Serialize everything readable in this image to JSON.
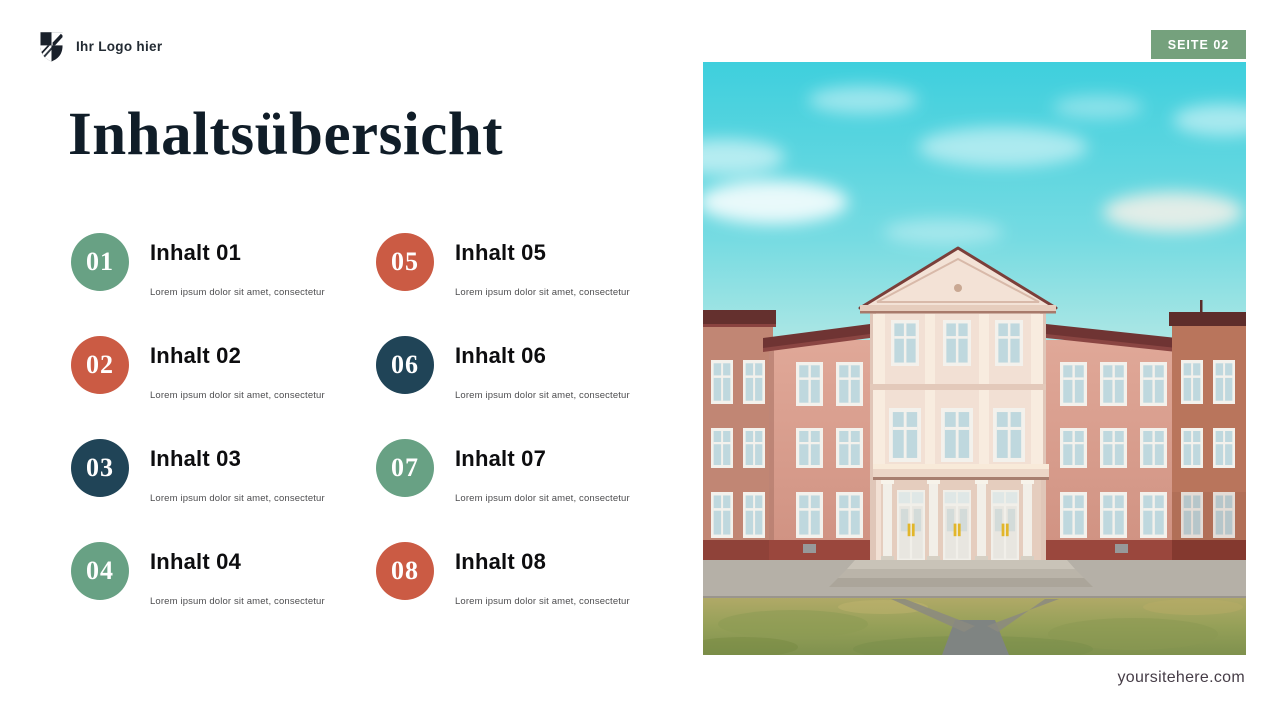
{
  "header": {
    "logo_text": "Ihr Logo hier",
    "logo_icon": "shield-icon",
    "badge": "SEITE 02"
  },
  "title": "Inhaltsübersicht",
  "items": [
    {
      "number": "01",
      "title": "Inhalt 01",
      "subtitle": "Lorem ipsum dolor sit amet, consectetur",
      "color": "#68a184"
    },
    {
      "number": "02",
      "title": "Inhalt 02",
      "subtitle": "Lorem ipsum dolor sit amet, consectetur",
      "color": "#cb5b44"
    },
    {
      "number": "03",
      "title": "Inhalt 03",
      "subtitle": "Lorem ipsum dolor sit amet, consectetur",
      "color": "#204457"
    },
    {
      "number": "04",
      "title": "Inhalt 04",
      "subtitle": "Lorem ipsum dolor sit amet, consectetur",
      "color": "#68a184"
    },
    {
      "number": "05",
      "title": "Inhalt 05",
      "subtitle": "Lorem ipsum dolor sit amet, consectetur",
      "color": "#cb5b44"
    },
    {
      "number": "06",
      "title": "Inhalt 06",
      "subtitle": "Lorem ipsum dolor sit amet, consectetur",
      "color": "#204457"
    },
    {
      "number": "07",
      "title": "Inhalt 07",
      "subtitle": "Lorem ipsum dolor sit amet, consectetur",
      "color": "#68a184"
    },
    {
      "number": "08",
      "title": "Inhalt 08",
      "subtitle": "Lorem ipsum dolor sit amet, consectetur",
      "color": "#cb5b44"
    }
  ],
  "footer": {
    "website": "yoursitehere.com"
  },
  "colors": {
    "badge_bg": "#75a17d",
    "accent_green": "#68a184",
    "accent_orange": "#cb5b44",
    "accent_navy": "#204457",
    "title_text": "#101d28"
  }
}
